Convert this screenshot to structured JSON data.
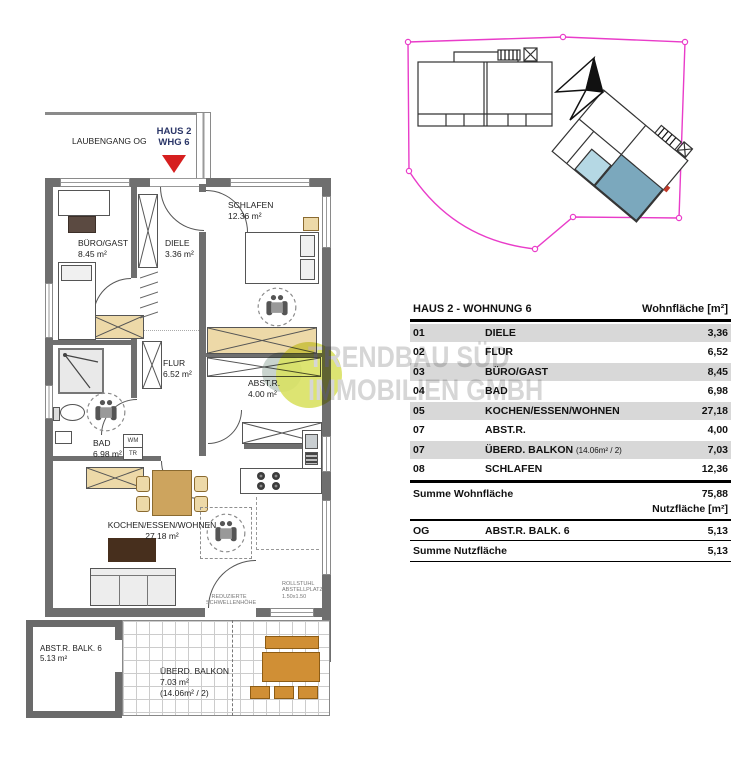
{
  "colors": {
    "boundary_magenta": "#e93cc9",
    "unit_highlight_blue": "#7ba8bd",
    "balcony_light_blue": "#b5d8e4",
    "entrance_arrow_red": "#d61f1f",
    "marker_navy": "#2b3668",
    "watermark_green": "#d9e163",
    "table_row_shade": "#d8d8d8",
    "wall_gray": "#6f6f6f"
  },
  "floor_plan": {
    "laubengang_label": "LAUBENGANG OG",
    "unit_marker": {
      "line1": "HAUS 2",
      "line2": "WHG 6"
    },
    "rooms": {
      "schlafen": {
        "name": "SCHLAFEN",
        "area": "12.36 m²"
      },
      "buero": {
        "name": "BÜRO/GAST",
        "area": "8.45 m²"
      },
      "diele": {
        "name": "DIELE",
        "area": "3.36 m²"
      },
      "flur": {
        "name": "FLUR",
        "area": "6.52 m²"
      },
      "abstr": {
        "name": "ABST.R.",
        "area": "4.00 m²"
      },
      "bad": {
        "name": "BAD",
        "area": "6.98 m²"
      },
      "wohnen": {
        "name": "KOCHEN/ESSEN/WOHNEN",
        "area": "27.18 m²"
      },
      "abstr_balk": {
        "name": "ABST.R. BALK. 6",
        "area": "5.13 m²"
      },
      "balkon": {
        "name": "ÜBERD. BALKON",
        "area": "7.03 m²",
        "note": "(14.06m² / 2)"
      }
    },
    "annotations": {
      "wm": "WM",
      "tr": "TR",
      "threshold": [
        "REDUZIERTE",
        "SCHWELLENHÖHE"
      ],
      "wheelchair_space": [
        "ROLLSTUHL",
        "ABSTELLPLATZ",
        "1.50x1.50"
      ]
    }
  },
  "watermark": {
    "line1": "TRENDBAU SÜD",
    "line2": "IMMOBILIEN GMBH"
  },
  "tables": {
    "wohnflaeche": {
      "title": "HAUS 2 - WOHNUNG 6",
      "unit_header": "Wohnfläche [m²]",
      "rows": [
        {
          "nr": "01",
          "name": "DIELE",
          "value": "3,36"
        },
        {
          "nr": "02",
          "name": "FLUR",
          "value": "6,52"
        },
        {
          "nr": "03",
          "name": "BÜRO/GAST",
          "value": "8,45"
        },
        {
          "nr": "04",
          "name": "BAD",
          "value": "6,98"
        },
        {
          "nr": "05",
          "name": "KOCHEN/ESSEN/WOHNEN",
          "value": "27,18"
        },
        {
          "nr": "07",
          "name": "ABST.R.",
          "value": "4,00"
        },
        {
          "nr": "07",
          "name": "ÜBERD. BALKON",
          "note": "(14.06m² / 2)",
          "value": "7,03"
        },
        {
          "nr": "08",
          "name": "SCHLAFEN",
          "value": "12,36"
        }
      ],
      "sum_label": "Summe Wohnfläche",
      "sum_value": "75,88"
    },
    "nutzflaeche": {
      "unit_header": "Nutzfläche [m²]",
      "rows": [
        {
          "nr": "OG",
          "name": "ABST.R. BALK. 6",
          "value": "5,13"
        }
      ],
      "sum_label": "Summe Nutzfläche",
      "sum_value": "5,13"
    }
  }
}
